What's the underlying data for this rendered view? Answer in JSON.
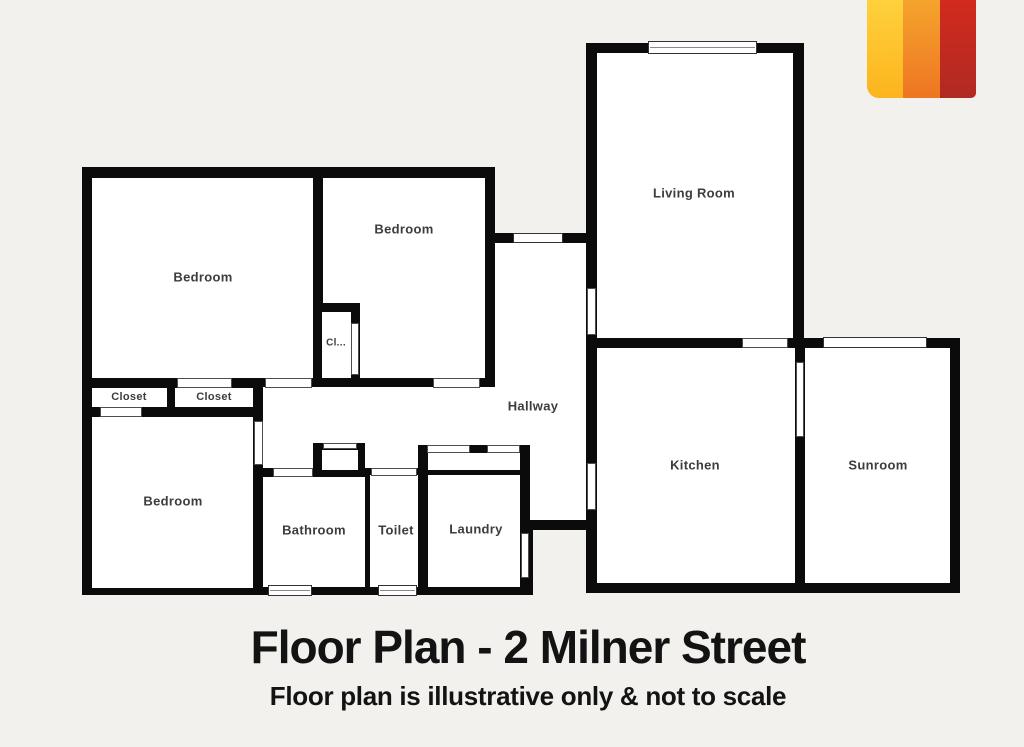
{
  "title": {
    "text": "Floor Plan - 2 Milner Street"
  },
  "subtitle": {
    "text": "Floor plan is illustrative only & not to scale"
  },
  "page": {
    "background": "#f2f1ee",
    "wall_color": "#0b0b0b",
    "floor_color": "#ffffff",
    "label_color": "#3d3d3d"
  },
  "logo": {
    "stripes": [
      {
        "name": "logo-stripe-yellow",
        "from": "#ffd13d",
        "to": "#fcb41d"
      },
      {
        "name": "logo-stripe-orange",
        "from": "#f5a42d",
        "to": "#ee7522"
      },
      {
        "name": "logo-stripe-red",
        "from": "#d22a1e",
        "to": "#b02a22"
      }
    ]
  },
  "floorplan": {
    "shapes": [
      {
        "type": "wall",
        "name": "wall-block-top-left",
        "x": 82,
        "y": 167,
        "w": 413,
        "h": 220
      },
      {
        "type": "wall",
        "name": "wall-block-bottom-left",
        "x": 82,
        "y": 378,
        "w": 181,
        "h": 217
      },
      {
        "type": "wall",
        "name": "wall-block-middle-upper",
        "x": 253,
        "y": 378,
        "w": 344,
        "h": 90
      },
      {
        "type": "wall",
        "name": "wall-block-middle-lower",
        "x": 253,
        "y": 468,
        "w": 280,
        "h": 127
      },
      {
        "type": "wall",
        "name": "wall-block-corridor-south",
        "x": 520,
        "y": 468,
        "w": 77,
        "h": 62
      },
      {
        "type": "wall",
        "name": "wall-block-hallway",
        "x": 485,
        "y": 233,
        "w": 112,
        "h": 154
      },
      {
        "type": "wall",
        "name": "wall-block-living",
        "x": 586,
        "y": 43,
        "w": 218,
        "h": 305
      },
      {
        "type": "wall",
        "name": "wall-block-kitchen-sunroom",
        "x": 586,
        "y": 338,
        "w": 374,
        "h": 255
      },
      {
        "type": "floor",
        "name": "floor-bedroom-nw",
        "x": 92,
        "y": 178,
        "w": 221,
        "h": 200
      },
      {
        "type": "floor",
        "name": "floor-bedroom-n",
        "x": 323,
        "y": 178,
        "w": 162,
        "h": 200
      },
      {
        "type": "floor",
        "name": "floor-closet-w",
        "x": 92,
        "y": 388,
        "w": 75,
        "h": 19
      },
      {
        "type": "floor",
        "name": "floor-closet-mid",
        "x": 175,
        "y": 388,
        "w": 78,
        "h": 19
      },
      {
        "type": "floor",
        "name": "floor-bedroom-sw",
        "x": 92,
        "y": 417,
        "w": 161,
        "h": 171
      },
      {
        "type": "floor",
        "name": "floor-hallway-upper",
        "x": 495,
        "y": 243,
        "w": 91,
        "h": 144
      },
      {
        "type": "floor",
        "name": "floor-hallway-lower",
        "x": 263,
        "y": 387,
        "w": 323,
        "h": 58
      },
      {
        "type": "floor",
        "name": "floor-hallway-bath-approach",
        "x": 263,
        "y": 445,
        "w": 50,
        "h": 23
      },
      {
        "type": "floor",
        "name": "floor-hallway-toilet-approach",
        "x": 365,
        "y": 445,
        "w": 53,
        "h": 23
      },
      {
        "type": "floor",
        "name": "floor-hallway-kitchen-approach",
        "x": 530,
        "y": 445,
        "w": 56,
        "h": 75
      },
      {
        "type": "floor",
        "name": "floor-bathroom",
        "x": 263,
        "y": 477,
        "w": 102,
        "h": 110
      },
      {
        "type": "floor",
        "name": "floor-toilet",
        "x": 370,
        "y": 475,
        "w": 48,
        "h": 112
      },
      {
        "type": "floor",
        "name": "floor-laundry-niche",
        "x": 428,
        "y": 453,
        "w": 92,
        "h": 17
      },
      {
        "type": "floor",
        "name": "floor-laundry",
        "x": 428,
        "y": 475,
        "w": 92,
        "h": 112
      },
      {
        "type": "floor",
        "name": "floor-living-room",
        "x": 597,
        "y": 53,
        "w": 196,
        "h": 285
      },
      {
        "type": "floor",
        "name": "floor-kitchen",
        "x": 597,
        "y": 348,
        "w": 198,
        "h": 235
      },
      {
        "type": "floor",
        "name": "floor-sunroom",
        "x": 805,
        "y": 348,
        "w": 145,
        "h": 235
      },
      {
        "type": "wall",
        "name": "wall-closet-bedroom-n",
        "x": 313,
        "y": 303,
        "w": 47,
        "h": 82
      },
      {
        "type": "wall",
        "name": "wall-bathroom-niche",
        "x": 313,
        "y": 443,
        "w": 52,
        "h": 34
      },
      {
        "type": "floor",
        "name": "floor-closet-bedroom-n",
        "x": 322,
        "y": 312,
        "w": 29,
        "h": 66
      },
      {
        "type": "floor",
        "name": "floor-bathroom-niche",
        "x": 322,
        "y": 450,
        "w": 36,
        "h": 20
      },
      {
        "type": "opening",
        "name": "door-bedroom-nw-closet",
        "x": 177,
        "y": 378,
        "w": 55,
        "h": 10
      },
      {
        "type": "opening",
        "name": "door-bedroom-nw-hall",
        "x": 265,
        "y": 378,
        "w": 47,
        "h": 10
      },
      {
        "type": "opening",
        "name": "door-bedroom-n-hall",
        "x": 433,
        "y": 378,
        "w": 47,
        "h": 10
      },
      {
        "type": "opening",
        "name": "door-closet-w-bedroom-sw",
        "x": 100,
        "y": 407,
        "w": 42,
        "h": 10
      },
      {
        "type": "opening",
        "name": "door-bedroom-sw",
        "x": 254,
        "y": 421,
        "w": 9,
        "h": 44
      },
      {
        "type": "opening",
        "name": "door-closet-bedroom-n",
        "x": 351,
        "y": 323,
        "w": 8,
        "h": 52
      },
      {
        "type": "opening",
        "name": "door-hallway-living",
        "x": 587,
        "y": 288,
        "w": 9,
        "h": 47
      },
      {
        "type": "opening",
        "name": "door-living-kitchen",
        "x": 742,
        "y": 338,
        "w": 46,
        "h": 10
      },
      {
        "type": "opening",
        "name": "door-hallway-kitchen",
        "x": 587,
        "y": 463,
        "w": 9,
        "h": 47
      },
      {
        "type": "opening",
        "name": "door-kitchen-sunroom",
        "x": 796,
        "y": 362,
        "w": 8,
        "h": 75
      },
      {
        "type": "opening",
        "name": "door-bathroom",
        "x": 273,
        "y": 468,
        "w": 40,
        "h": 9
      },
      {
        "type": "opening",
        "name": "door-toilet",
        "x": 371,
        "y": 468,
        "w": 46,
        "h": 8
      },
      {
        "type": "opening",
        "name": "door-laundry-niche-w",
        "x": 427,
        "y": 445,
        "w": 43,
        "h": 8
      },
      {
        "type": "opening",
        "name": "door-laundry-niche-e",
        "x": 487,
        "y": 445,
        "w": 33,
        "h": 8
      },
      {
        "type": "opening",
        "name": "door-laundry",
        "x": 521,
        "y": 533,
        "w": 8,
        "h": 45
      },
      {
        "type": "opening",
        "name": "opening-bathroom-niche-top",
        "x": 323,
        "y": 443,
        "w": 34,
        "h": 6
      },
      {
        "type": "window",
        "name": "window-living-room",
        "x": 648,
        "y": 41,
        "w": 109,
        "h": 13,
        "mid": true
      },
      {
        "type": "window",
        "name": "window-sunroom",
        "x": 823,
        "y": 337,
        "w": 104,
        "h": 11
      },
      {
        "type": "window",
        "name": "window-hallway",
        "x": 513,
        "y": 233,
        "w": 50,
        "h": 10
      },
      {
        "type": "window",
        "name": "window-bathroom",
        "x": 268,
        "y": 585,
        "w": 44,
        "h": 11,
        "mid": true
      },
      {
        "type": "window",
        "name": "window-toilet",
        "x": 378,
        "y": 585,
        "w": 39,
        "h": 11,
        "mid": true
      }
    ],
    "labels": [
      {
        "text": "Bedroom",
        "x": 203,
        "y": 277,
        "size": 13
      },
      {
        "text": "Bedroom",
        "x": 404,
        "y": 229,
        "size": 13
      },
      {
        "text": "Cl...",
        "x": 336,
        "y": 343,
        "size": 10
      },
      {
        "text": "Closet",
        "x": 129,
        "y": 397,
        "size": 11
      },
      {
        "text": "Closet",
        "x": 214,
        "y": 397,
        "size": 11
      },
      {
        "text": "Bedroom",
        "x": 173,
        "y": 501,
        "size": 13
      },
      {
        "text": "Hallway",
        "x": 533,
        "y": 406,
        "size": 13
      },
      {
        "text": "Bathroom",
        "x": 314,
        "y": 530,
        "size": 13
      },
      {
        "text": "Toilet",
        "x": 396,
        "y": 530,
        "size": 13
      },
      {
        "text": "Laundry",
        "x": 476,
        "y": 529,
        "size": 13
      },
      {
        "text": "Living Room",
        "x": 694,
        "y": 193,
        "size": 13
      },
      {
        "text": "Kitchen",
        "x": 695,
        "y": 465,
        "size": 13
      },
      {
        "text": "Sunroom",
        "x": 878,
        "y": 465,
        "size": 13
      }
    ]
  }
}
